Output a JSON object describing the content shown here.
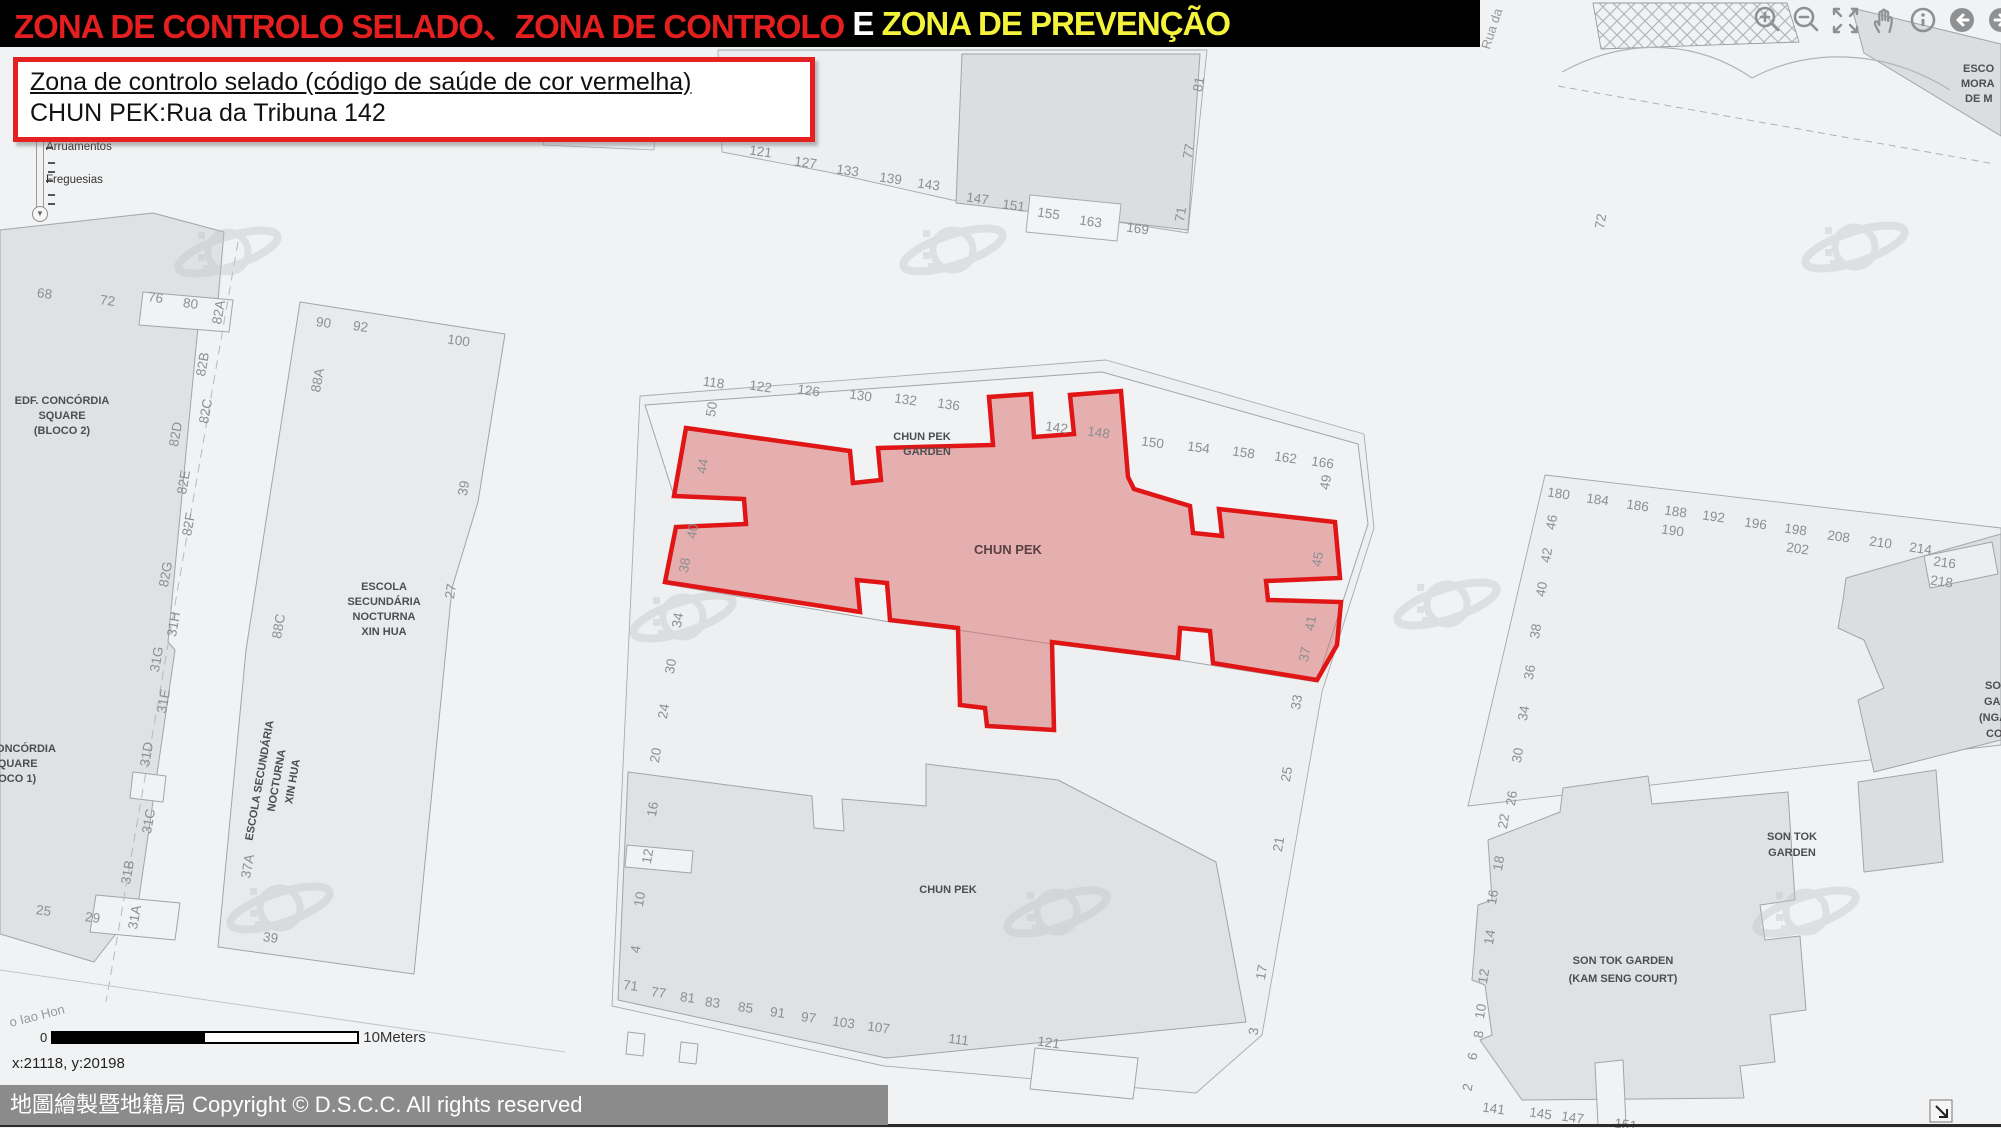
{
  "banner": {
    "segments": [
      {
        "text": "ZONA DE CONTROLO SELADO、ZONA DE CONTROLO ",
        "color": "#e31f1f"
      },
      {
        "text": "E ",
        "color": "#ffffff"
      },
      {
        "text": "ZONA DE PREVENÇÃO",
        "color": "#f3f33c"
      }
    ]
  },
  "info_box": {
    "line1": "Zona de controlo selado (código de saúde de cor vermelha)",
    "line2": "CHUN PEK:Rua da Tribuna 142"
  },
  "toc": {
    "items": [
      "Arruamentos",
      "Freguesias"
    ]
  },
  "toolbar": {
    "icons": [
      "zoom-in",
      "zoom-out",
      "full-extent",
      "pan",
      "identify",
      "back",
      "forward"
    ]
  },
  "scale_bar": {
    "start": "0",
    "end": "10Meters"
  },
  "status": {
    "coordinates": "x:21118, y:20198"
  },
  "copyright": "地圖繪製暨地籍局 Copyright © D.S.C.C. All rights reserved",
  "red_zone": {
    "name": "CHUN PEK",
    "stroke": "#e01616",
    "fill": "rgba(217,107,107,0.5)"
  },
  "map_labels": [
    {
      "t": "68",
      "x": 44,
      "y": 298,
      "r": 8,
      "c": "num"
    },
    {
      "t": "72",
      "x": 107,
      "y": 305,
      "r": 8,
      "c": "num"
    },
    {
      "t": "76",
      "x": 155,
      "y": 302,
      "r": 8,
      "c": "num"
    },
    {
      "t": "80",
      "x": 190,
      "y": 308,
      "r": 8,
      "c": "num"
    },
    {
      "t": "82A",
      "x": 223,
      "y": 313,
      "r": -80,
      "c": "num"
    },
    {
      "t": "82B",
      "x": 207,
      "y": 365,
      "r": -80,
      "c": "num"
    },
    {
      "t": "82C",
      "x": 210,
      "y": 412,
      "r": -80,
      "c": "num"
    },
    {
      "t": "82D",
      "x": 180,
      "y": 435,
      "r": -80,
      "c": "num"
    },
    {
      "t": "82E",
      "x": 188,
      "y": 483,
      "r": -80,
      "c": "num"
    },
    {
      "t": "82F",
      "x": 193,
      "y": 525,
      "r": -80,
      "c": "num"
    },
    {
      "t": "82G",
      "x": 170,
      "y": 575,
      "r": -80,
      "c": "num"
    },
    {
      "t": "31H",
      "x": 178,
      "y": 625,
      "r": -80,
      "c": "num"
    },
    {
      "t": "31G",
      "x": 161,
      "y": 660,
      "r": -80,
      "c": "num"
    },
    {
      "t": "31E",
      "x": 168,
      "y": 702,
      "r": -80,
      "c": "num"
    },
    {
      "t": "31D",
      "x": 151,
      "y": 755,
      "r": -80,
      "c": "num"
    },
    {
      "t": "31C",
      "x": 153,
      "y": 822,
      "r": -80,
      "c": "num"
    },
    {
      "t": "31B",
      "x": 132,
      "y": 873,
      "r": -80,
      "c": "num"
    },
    {
      "t": "31A",
      "x": 139,
      "y": 918,
      "r": -80,
      "c": "num"
    },
    {
      "t": "25",
      "x": 43,
      "y": 915,
      "r": 8,
      "c": "num"
    },
    {
      "t": "29",
      "x": 92,
      "y": 922,
      "r": 8,
      "c": "num"
    },
    {
      "t": "EDF. CONCÓRDIA",
      "x": 62,
      "y": 404,
      "r": 0,
      "c": "name"
    },
    {
      "t": "SQUARE",
      "x": 62,
      "y": 419,
      "r": 0,
      "c": "name"
    },
    {
      "t": "(BLOCO 2)",
      "x": 62,
      "y": 434,
      "r": 0,
      "c": "name"
    },
    {
      "t": "CONCÓRDIA",
      "x": 22,
      "y": 752,
      "r": 0,
      "c": "name"
    },
    {
      "t": "SQUARE",
      "x": 14,
      "y": 767,
      "r": 0,
      "c": "name"
    },
    {
      "t": "(BLOCO 1)",
      "x": 8,
      "y": 782,
      "r": 0,
      "c": "name"
    },
    {
      "t": "90",
      "x": 323,
      "y": 327,
      "r": 8,
      "c": "num"
    },
    {
      "t": "92",
      "x": 360,
      "y": 331,
      "r": 8,
      "c": "num"
    },
    {
      "t": "100",
      "x": 458,
      "y": 345,
      "r": 8,
      "c": "num"
    },
    {
      "t": "88A",
      "x": 322,
      "y": 381,
      "r": -80,
      "c": "num"
    },
    {
      "t": "39",
      "x": 468,
      "y": 489,
      "r": -80,
      "c": "num"
    },
    {
      "t": "27",
      "x": 455,
      "y": 592,
      "r": -80,
      "c": "num"
    },
    {
      "t": "88C",
      "x": 283,
      "y": 627,
      "r": -80,
      "c": "num"
    },
    {
      "t": "ESCOLA",
      "x": 384,
      "y": 590,
      "r": 0,
      "c": "name"
    },
    {
      "t": "SECUNDÁRIA",
      "x": 384,
      "y": 605,
      "r": 0,
      "c": "name"
    },
    {
      "t": "NOCTURNA",
      "x": 384,
      "y": 620,
      "r": 0,
      "c": "name"
    },
    {
      "t": "XIN HUA",
      "x": 384,
      "y": 635,
      "r": 0,
      "c": "name"
    },
    {
      "t": "ESCOLA SECUNDÁRIA",
      "x": 263,
      "y": 781,
      "r": -80,
      "c": "name"
    },
    {
      "t": "NOCTURNA",
      "x": 280,
      "y": 781,
      "r": -80,
      "c": "name"
    },
    {
      "t": "XIN HUA",
      "x": 296,
      "y": 782,
      "r": -80,
      "c": "name"
    },
    {
      "t": "37A",
      "x": 252,
      "y": 867,
      "r": -80,
      "c": "num"
    },
    {
      "t": "39",
      "x": 270,
      "y": 942,
      "r": 8,
      "c": "num"
    },
    {
      "t": "118",
      "x": 713,
      "y": 387,
      "r": 8,
      "c": "num"
    },
    {
      "t": "122",
      "x": 760,
      "y": 391,
      "r": 8,
      "c": "num"
    },
    {
      "t": "126",
      "x": 808,
      "y": 395,
      "r": 8,
      "c": "num"
    },
    {
      "t": "130",
      "x": 860,
      "y": 400,
      "r": 8,
      "c": "num"
    },
    {
      "t": "132",
      "x": 905,
      "y": 404,
      "r": 8,
      "c": "num"
    },
    {
      "t": "136",
      "x": 948,
      "y": 409,
      "r": 8,
      "c": "num"
    },
    {
      "t": "CHUN PEK",
      "x": 922,
      "y": 440,
      "r": 0,
      "c": "name"
    },
    {
      "t": "GARDEN",
      "x": 927,
      "y": 455,
      "r": 0,
      "c": "name"
    },
    {
      "t": "142",
      "x": 1056,
      "y": 432,
      "r": 8,
      "c": "num"
    },
    {
      "t": "148",
      "x": 1098,
      "y": 437,
      "r": 8,
      "c": "num"
    },
    {
      "t": "150",
      "x": 1152,
      "y": 447,
      "r": 8,
      "c": "num"
    },
    {
      "t": "154",
      "x": 1198,
      "y": 452,
      "r": 8,
      "c": "num"
    },
    {
      "t": "158",
      "x": 1243,
      "y": 457,
      "r": 8,
      "c": "num"
    },
    {
      "t": "162",
      "x": 1285,
      "y": 462,
      "r": 8,
      "c": "num"
    },
    {
      "t": "166",
      "x": 1322,
      "y": 467,
      "r": 8,
      "c": "num"
    },
    {
      "t": "50",
      "x": 716,
      "y": 410,
      "r": -80,
      "c": "num"
    },
    {
      "t": "44",
      "x": 707,
      "y": 467,
      "r": -80,
      "c": "num"
    },
    {
      "t": "40",
      "x": 697,
      "y": 532,
      "r": -80,
      "c": "num"
    },
    {
      "t": "38",
      "x": 689,
      "y": 566,
      "r": -80,
      "c": "num"
    },
    {
      "t": "34",
      "x": 682,
      "y": 621,
      "r": -80,
      "c": "num"
    },
    {
      "t": "49",
      "x": 1330,
      "y": 483,
      "r": -80,
      "c": "num"
    },
    {
      "t": "45",
      "x": 1322,
      "y": 560,
      "r": -80,
      "c": "num"
    },
    {
      "t": "41",
      "x": 1315,
      "y": 624,
      "r": -80,
      "c": "num"
    },
    {
      "t": "37",
      "x": 1309,
      "y": 655,
      "r": -80,
      "c": "num"
    },
    {
      "t": "CHUN PEK",
      "x": 1008,
      "y": 554,
      "r": 0,
      "c": "redname"
    },
    {
      "t": "30",
      "x": 675,
      "y": 667,
      "r": -80,
      "c": "num"
    },
    {
      "t": "24",
      "x": 668,
      "y": 712,
      "r": -80,
      "c": "num"
    },
    {
      "t": "20",
      "x": 660,
      "y": 756,
      "r": -80,
      "c": "num"
    },
    {
      "t": "33",
      "x": 1301,
      "y": 703,
      "r": -80,
      "c": "num"
    },
    {
      "t": "25",
      "x": 1291,
      "y": 775,
      "r": -80,
      "c": "num"
    },
    {
      "t": "21",
      "x": 1283,
      "y": 845,
      "r": -80,
      "c": "num"
    },
    {
      "t": "17",
      "x": 1266,
      "y": 973,
      "r": -80,
      "c": "num"
    },
    {
      "t": "3",
      "x": 1258,
      "y": 1032,
      "r": -80,
      "c": "num"
    },
    {
      "t": "16",
      "x": 657,
      "y": 810,
      "r": -80,
      "c": "num"
    },
    {
      "t": "12",
      "x": 652,
      "y": 857,
      "r": -80,
      "c": "num"
    },
    {
      "t": "10",
      "x": 644,
      "y": 900,
      "r": -80,
      "c": "num"
    },
    {
      "t": "4",
      "x": 640,
      "y": 950,
      "r": -80,
      "c": "num"
    },
    {
      "t": "CHUN PEK",
      "x": 948,
      "y": 893,
      "r": 0,
      "c": "name"
    },
    {
      "t": "71",
      "x": 630,
      "y": 990,
      "r": 8,
      "c": "num"
    },
    {
      "t": "77",
      "x": 658,
      "y": 997,
      "r": 8,
      "c": "num"
    },
    {
      "t": "81",
      "x": 687,
      "y": 1002,
      "r": 8,
      "c": "num"
    },
    {
      "t": "83",
      "x": 712,
      "y": 1007,
      "r": 8,
      "c": "num"
    },
    {
      "t": "85",
      "x": 745,
      "y": 1012,
      "r": 8,
      "c": "num"
    },
    {
      "t": "91",
      "x": 777,
      "y": 1017,
      "r": 8,
      "c": "num"
    },
    {
      "t": "97",
      "x": 808,
      "y": 1022,
      "r": 8,
      "c": "num"
    },
    {
      "t": "103",
      "x": 843,
      "y": 1027,
      "r": 8,
      "c": "num"
    },
    {
      "t": "107",
      "x": 878,
      "y": 1032,
      "r": 8,
      "c": "num"
    },
    {
      "t": "111",
      "x": 958,
      "y": 1044,
      "r": 8,
      "c": "num"
    },
    {
      "t": "121",
      "x": 1048,
      "y": 1047,
      "r": 8,
      "c": "num"
    },
    {
      "t": "121",
      "x": 760,
      "y": 156,
      "r": 8,
      "c": "num"
    },
    {
      "t": "127",
      "x": 805,
      "y": 167,
      "r": 8,
      "c": "num"
    },
    {
      "t": "133",
      "x": 847,
      "y": 175,
      "r": 8,
      "c": "num"
    },
    {
      "t": "139",
      "x": 890,
      "y": 183,
      "r": 8,
      "c": "num"
    },
    {
      "t": "143",
      "x": 928,
      "y": 189,
      "r": 8,
      "c": "num"
    },
    {
      "t": "147",
      "x": 977,
      "y": 203,
      "r": 8,
      "c": "num"
    },
    {
      "t": "151",
      "x": 1013,
      "y": 210,
      "r": 8,
      "c": "num"
    },
    {
      "t": "155",
      "x": 1048,
      "y": 218,
      "r": 8,
      "c": "num"
    },
    {
      "t": "163",
      "x": 1090,
      "y": 226,
      "r": 8,
      "c": "num"
    },
    {
      "t": "169",
      "x": 1137,
      "y": 233,
      "r": 8,
      "c": "num"
    },
    {
      "t": "81",
      "x": 1203,
      "y": 85,
      "r": -80,
      "c": "num"
    },
    {
      "t": "77",
      "x": 1193,
      "y": 152,
      "r": -80,
      "c": "num"
    },
    {
      "t": "71",
      "x": 1185,
      "y": 215,
      "r": -80,
      "c": "num"
    },
    {
      "t": "72",
      "x": 1605,
      "y": 222,
      "r": -80,
      "c": "num"
    },
    {
      "t": "Rua da",
      "x": 1496,
      "y": 30,
      "r": -72,
      "c": "street"
    },
    {
      "t": "o Iao Hon",
      "x": 38,
      "y": 1020,
      "r": -14,
      "c": "street"
    },
    {
      "t": "ESCO",
      "x": 1963,
      "y": 72,
      "r": 0,
      "c": "name-st"
    },
    {
      "t": "MORA",
      "x": 1961,
      "y": 87,
      "r": 0,
      "c": "name-st"
    },
    {
      "t": "DE M",
      "x": 1965,
      "y": 102,
      "r": 0,
      "c": "name-st"
    },
    {
      "t": "180",
      "x": 1558,
      "y": 498,
      "r": 8,
      "c": "num"
    },
    {
      "t": "184",
      "x": 1597,
      "y": 504,
      "r": 8,
      "c": "num"
    },
    {
      "t": "186",
      "x": 1637,
      "y": 510,
      "r": 8,
      "c": "num"
    },
    {
      "t": "188",
      "x": 1675,
      "y": 516,
      "r": 8,
      "c": "num"
    },
    {
      "t": "190",
      "x": 1672,
      "y": 535,
      "r": 8,
      "c": "num"
    },
    {
      "t": "192",
      "x": 1713,
      "y": 521,
      "r": 8,
      "c": "num"
    },
    {
      "t": "196",
      "x": 1755,
      "y": 528,
      "r": 8,
      "c": "num"
    },
    {
      "t": "198",
      "x": 1795,
      "y": 534,
      "r": 8,
      "c": "num"
    },
    {
      "t": "202",
      "x": 1797,
      "y": 553,
      "r": 8,
      "c": "num"
    },
    {
      "t": "208",
      "x": 1838,
      "y": 541,
      "r": 8,
      "c": "num"
    },
    {
      "t": "210",
      "x": 1880,
      "y": 547,
      "r": 8,
      "c": "num"
    },
    {
      "t": "214",
      "x": 1920,
      "y": 553,
      "r": 8,
      "c": "num"
    },
    {
      "t": "216",
      "x": 1944,
      "y": 567,
      "r": 8,
      "c": "num"
    },
    {
      "t": "218",
      "x": 1941,
      "y": 586,
      "r": 8,
      "c": "num"
    },
    {
      "t": "46",
      "x": 1556,
      "y": 523,
      "r": -80,
      "c": "num"
    },
    {
      "t": "42",
      "x": 1551,
      "y": 556,
      "r": -80,
      "c": "num"
    },
    {
      "t": "40",
      "x": 1546,
      "y": 590,
      "r": -80,
      "c": "num"
    },
    {
      "t": "38",
      "x": 1540,
      "y": 632,
      "r": -80,
      "c": "num"
    },
    {
      "t": "36",
      "x": 1534,
      "y": 673,
      "r": -80,
      "c": "num"
    },
    {
      "t": "34",
      "x": 1528,
      "y": 714,
      "r": -80,
      "c": "num"
    },
    {
      "t": "30",
      "x": 1522,
      "y": 756,
      "r": -80,
      "c": "num"
    },
    {
      "t": "26",
      "x": 1516,
      "y": 799,
      "r": -80,
      "c": "num"
    },
    {
      "t": "SO",
      "x": 1985,
      "y": 689,
      "r": 0,
      "c": "name-st"
    },
    {
      "t": "GA",
      "x": 1984,
      "y": 705,
      "r": 0,
      "c": "name-st"
    },
    {
      "t": "(NGA",
      "x": 1979,
      "y": 721,
      "r": 0,
      "c": "name-st"
    },
    {
      "t": "CO",
      "x": 1986,
      "y": 737,
      "r": 0,
      "c": "name-st"
    },
    {
      "t": "SON TOK",
      "x": 1792,
      "y": 840,
      "r": 0,
      "c": "name"
    },
    {
      "t": "GARDEN",
      "x": 1792,
      "y": 856,
      "r": 0,
      "c": "name"
    },
    {
      "t": "SON TOK GARDEN",
      "x": 1623,
      "y": 964,
      "r": 0,
      "c": "name"
    },
    {
      "t": "(KAM SENG COURT)",
      "x": 1623,
      "y": 982,
      "r": 0,
      "c": "name"
    },
    {
      "t": "22",
      "x": 1508,
      "y": 822,
      "r": -80,
      "c": "num"
    },
    {
      "t": "18",
      "x": 1503,
      "y": 864,
      "r": -80,
      "c": "num"
    },
    {
      "t": "16",
      "x": 1497,
      "y": 898,
      "r": -80,
      "c": "num"
    },
    {
      "t": "14",
      "x": 1494,
      "y": 938,
      "r": -80,
      "c": "num"
    },
    {
      "t": "12",
      "x": 1488,
      "y": 977,
      "r": -80,
      "c": "num"
    },
    {
      "t": "10",
      "x": 1485,
      "y": 1012,
      "r": -80,
      "c": "num"
    },
    {
      "t": "8",
      "x": 1483,
      "y": 1035,
      "r": -80,
      "c": "num"
    },
    {
      "t": "6",
      "x": 1477,
      "y": 1057,
      "r": -80,
      "c": "num"
    },
    {
      "t": "2",
      "x": 1472,
      "y": 1088,
      "r": -80,
      "c": "num"
    },
    {
      "t": "141",
      "x": 1493,
      "y": 1113,
      "r": 8,
      "c": "num"
    },
    {
      "t": "145",
      "x": 1540,
      "y": 1118,
      "r": 8,
      "c": "num"
    },
    {
      "t": "147",
      "x": 1572,
      "y": 1122,
      "r": 8,
      "c": "num"
    },
    {
      "t": "151",
      "x": 1625,
      "y": 1129,
      "r": 8,
      "c": "num"
    }
  ]
}
